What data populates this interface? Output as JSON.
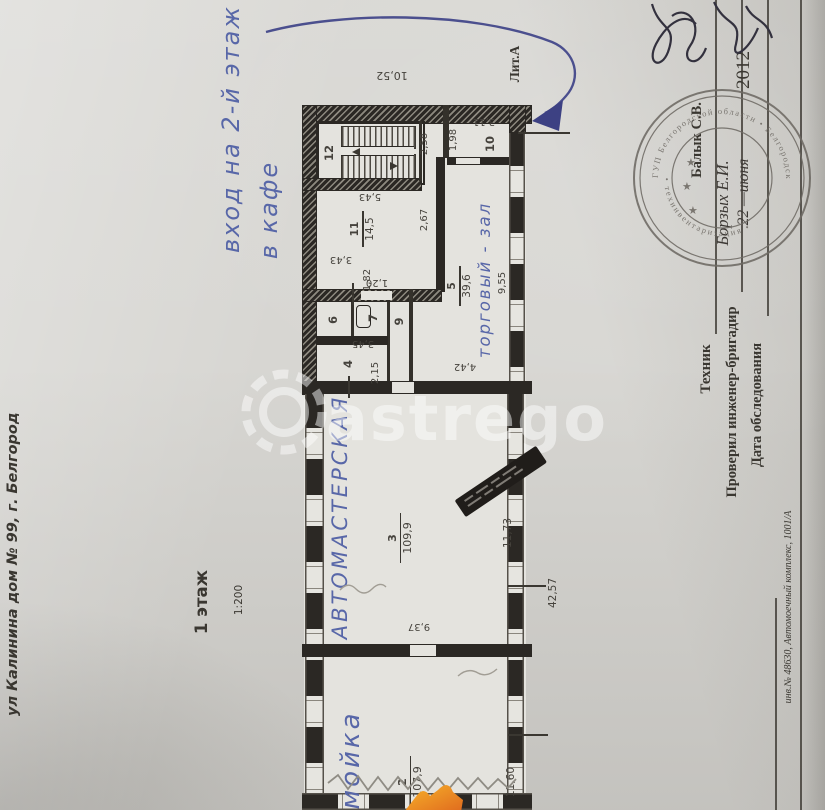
{
  "document": {
    "address": "ул Калинина дом № 99, г. Белгород",
    "floor_label": "1 этаж",
    "scale_label": "1:200",
    "liter_label": "Лит.А",
    "inventory_note": "инв.№ 48630, Автомоечный комплекс, 1001/А"
  },
  "handwritten": {
    "entry_note_line1": "вход на 2-й этаж",
    "entry_note_line2": "в кафе",
    "room3_name": "АВТОМАСТЕРСКАЯ",
    "room2_name": "мойка",
    "room5_name": "торговый - зал"
  },
  "form": {
    "technician_label": "Техник",
    "checked_by_label": "Проверил инженер-бригадир",
    "checked_by_name": "Борзых Е.И.",
    "survey_date_label": "Дата обследования",
    "survey_date_day_month": "22 —июня",
    "survey_date_year": "2012",
    "stamped_name": "Балык С.В."
  },
  "stamp": {
    "ring_text_top": "ГУП Белгородской области • Белгородской области",
    "ring_text_bottom": "• техинвентаризация •",
    "star": "★"
  },
  "watermark": {
    "text": "astrego"
  },
  "plan": {
    "rooms": {
      "r2": {
        "num": "2",
        "area": "107,9"
      },
      "r3": {
        "num": "3",
        "area": "109,9"
      },
      "r4": {
        "num": "4"
      },
      "r5": {
        "num": "5",
        "area": "39,6"
      },
      "r6": {
        "num": "6"
      },
      "r7": {
        "num": "7"
      },
      "r9": {
        "num": "9"
      },
      "r10": {
        "num": "10"
      },
      "r11": {
        "num": "11",
        "area": "14,5"
      },
      "r12": {
        "num": "12"
      }
    },
    "dims": {
      "d1052": "10,52",
      "d258": "2,58",
      "d198": "1,98",
      "d311": "3,11",
      "d543": "5,43",
      "d267": "2,67",
      "d343": "3,43",
      "d182": "1,82",
      "d120": "1,20",
      "d345": "3,45",
      "d215": "2,15",
      "d442": "4,42",
      "d955": "9,55",
      "d937": "9,37",
      "d1173": "11,73",
      "d4257": "42,57",
      "d1160": "11,60"
    }
  }
}
